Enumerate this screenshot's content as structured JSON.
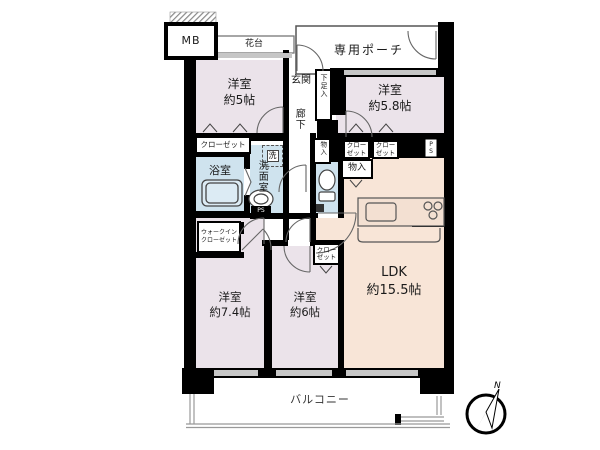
{
  "colors": {
    "wall": "#000000",
    "room_western": "#ebe3ea",
    "room_ldk": "#f8e5d7",
    "room_wet": "#cfe3ee",
    "window_sill": "#c6c6c6",
    "line": "#555555"
  },
  "plan": {
    "mb": "MB",
    "hanadai": "花台",
    "porch": "専用ポーチ",
    "genkan": "玄関",
    "shoe": "下足入",
    "corridor": "廊下",
    "closet": "クローゼット",
    "closet2": {
      "a": "クロー",
      "b": "ゼット"
    },
    "wic": {
      "a": "ウォークイン",
      "b": "クローゼット"
    },
    "mono": "物入",
    "ps": "PS",
    "psv": {
      "a": "P",
      "b": "S"
    },
    "bath": "浴室",
    "washer": "洗",
    "washroom": "洗面室",
    "rooms": {
      "r5": {
        "name": "洋室",
        "size": "約5帖"
      },
      "r58": {
        "name": "洋室",
        "size": "約5.8帖"
      },
      "r74": {
        "name": "洋室",
        "size": "約7.4帖"
      },
      "r6": {
        "name": "洋室",
        "size": "約6帖"
      },
      "ldk": {
        "name": "LDK",
        "size": "約15.5帖"
      }
    },
    "balcony": "バルコニー",
    "north": "N"
  }
}
